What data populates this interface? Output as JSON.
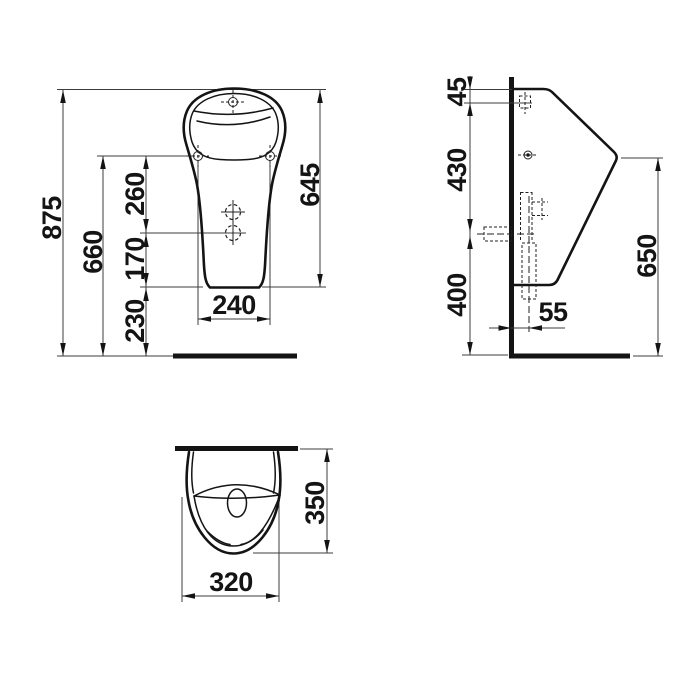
{
  "page": {
    "background": "#ffffff",
    "line_color": "#141414",
    "kind": "sanitaryware dimensional drawing"
  },
  "drawing": {
    "views": {
      "front": {
        "title": "front elevation",
        "dims": {
          "overall_height": "875",
          "fixing_height": "660",
          "fixing_to_outlet": "260",
          "outlet_to_bottom": "170",
          "bottom_clearance": "230",
          "ceramic_height": "645",
          "fixing_width": "240"
        }
      },
      "side": {
        "title": "side elevation",
        "dims": {
          "top_to_inlet": "45",
          "inlet_to_outlet": "430",
          "outlet_height": "400",
          "front_edge_height": "650",
          "outlet_offset": "55"
        }
      },
      "top": {
        "title": "plan view",
        "dims": {
          "depth": "350",
          "width": "320"
        }
      }
    }
  }
}
